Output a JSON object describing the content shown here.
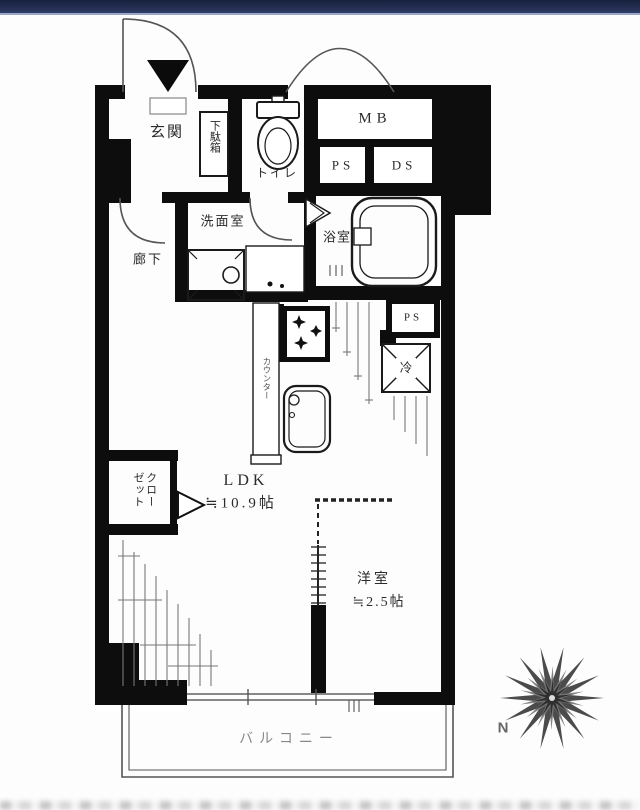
{
  "floorplan": {
    "labels": {
      "genkan": "玄関",
      "getabako": "下駄箱",
      "toilet": "トイレ",
      "mb": "MB",
      "ps_upper": "PS",
      "ds": "DS",
      "senmenshitsu": "洗面室",
      "rouka": "廊下",
      "yokushitsu": "浴室",
      "ps_kitchen": "PS",
      "counter": "カウンター",
      "fridge": "冷",
      "ldk": "LDK",
      "ldk_size": "≒10.9帖",
      "closet": "クローゼット",
      "youshitsu": "洋室",
      "youshitsu_size": "≒2.5帖",
      "balcony": "バルコニー"
    },
    "compass": {
      "north": "N"
    },
    "colors": {
      "wall": "#0d0d0d",
      "thin_line": "#555555",
      "top_bar": "#273255",
      "background": "#fdfdfd"
    }
  }
}
